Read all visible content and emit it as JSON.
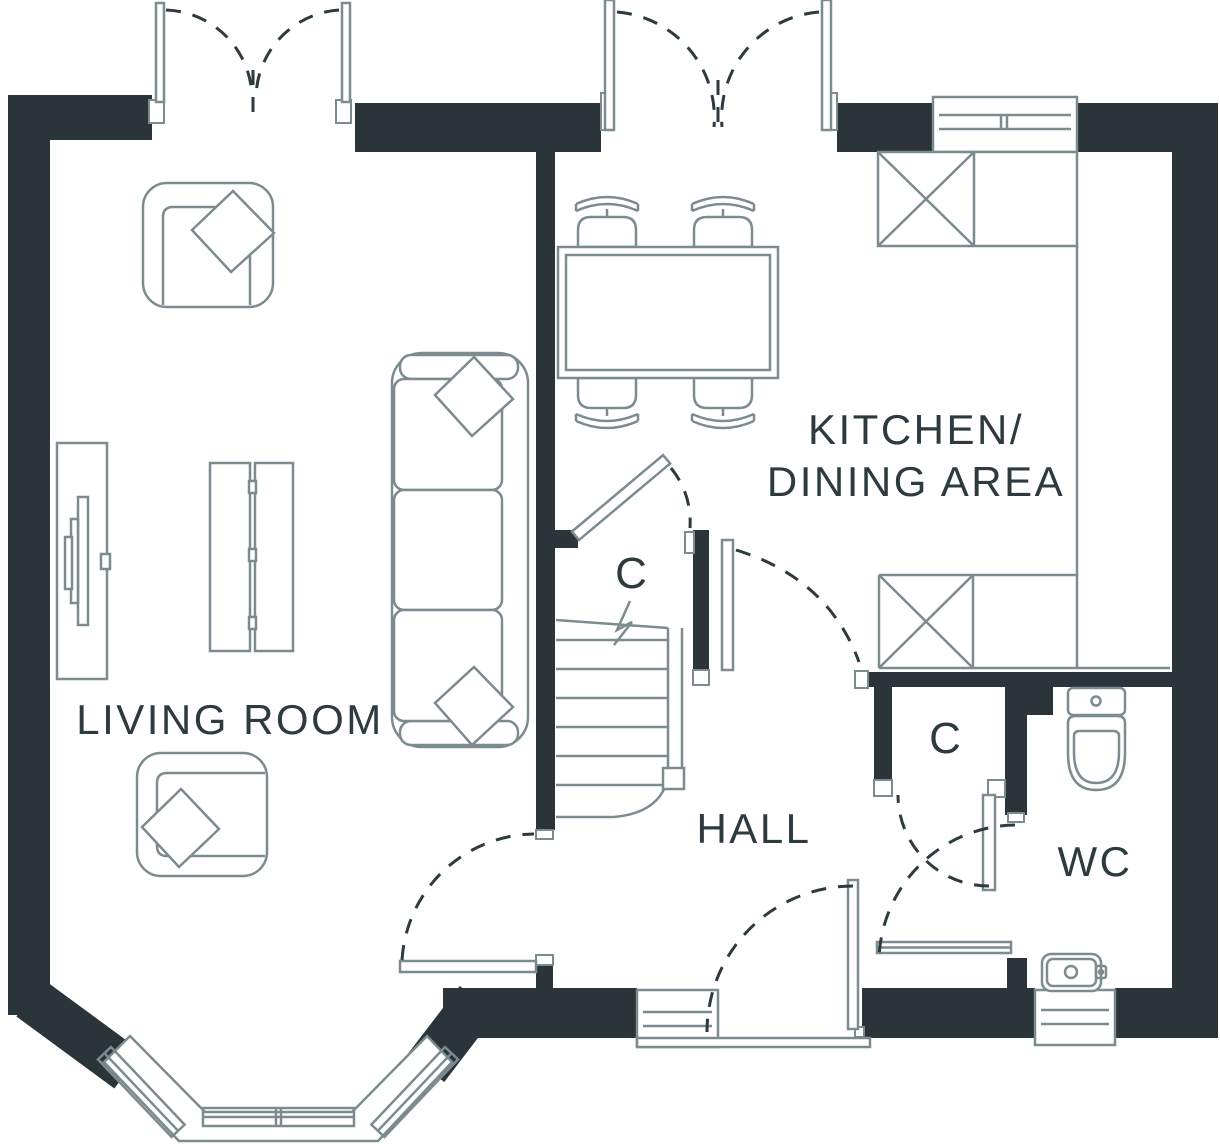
{
  "colors": {
    "wall": "#2b3539",
    "line": "#7c8b8e",
    "text": "#2d3a3e",
    "bg": "#ffffff"
  },
  "rooms": {
    "living_room": {
      "label": "LIVING ROOM"
    },
    "kitchen_dining": {
      "label_line1": "KITCHEN/",
      "label_line2": "DINING AREA"
    },
    "hall": {
      "label": "HALL"
    },
    "wc": {
      "label": "WC"
    },
    "cupboard_understairs": {
      "label": "C"
    },
    "cupboard_hall": {
      "label": "C"
    }
  },
  "furniture_symbols": [
    "armchair-with-cushion",
    "armchair-with-cushion",
    "three-seat-sofa-with-cushions",
    "tv-unit",
    "coffee-table",
    "dining-table",
    "dining-chair",
    "dining-chair",
    "dining-chair",
    "dining-chair",
    "kitchen-counter",
    "appliance-crossed-box",
    "appliance-crossed-box",
    "staircase-with-break-line",
    "toilet",
    "washbasin",
    "radiator"
  ],
  "window_symbols": [
    "french-doors-living-room",
    "french-doors-kitchen",
    "kitchen-window",
    "bay-window",
    "front-sidelight-window",
    "wc-window"
  ],
  "door_symbols": [
    "front-door",
    "living-room-door",
    "kitchen-door",
    "understairs-cupboard-door",
    "hall-cupboard-door",
    "wc-door"
  ]
}
